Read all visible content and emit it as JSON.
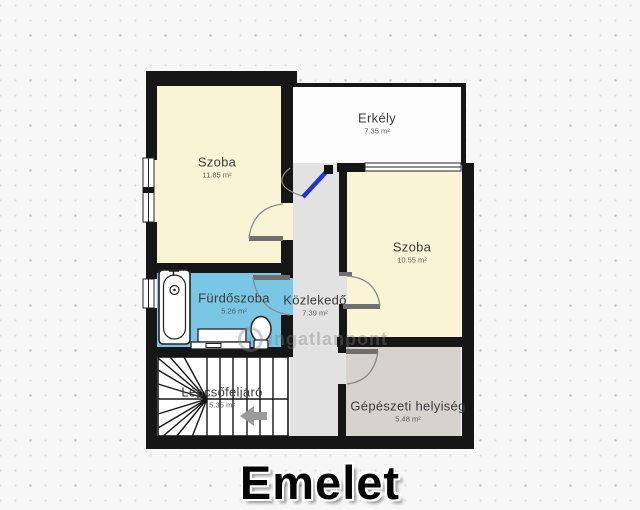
{
  "title": "Emelet",
  "watermark": {
    "brand": "otp",
    "name": "ingatlanpont"
  },
  "rooms": {
    "szoba1": {
      "label": "Szoba",
      "area": "11.85 m²"
    },
    "erkely": {
      "label": "Erkély",
      "area": "7.35 m²"
    },
    "szoba2": {
      "label": "Szoba",
      "area": "10.55 m²"
    },
    "furdoszoba": {
      "label": "Fürdőszoba",
      "area": "5.26 m²"
    },
    "kozlekedo": {
      "label": "Közlekedő",
      "area": "7.39 m²"
    },
    "lepcsofeljaro": {
      "label": "Lépcsőfeljáró",
      "area": "5.35 m²"
    },
    "gepeszeti": {
      "label": "Gépészeti helyiség",
      "area": "5.48 m²"
    }
  },
  "colors": {
    "wall": "#161616",
    "room_fill": "#f8f4d5",
    "bathroom_fill": "#79c7e4",
    "corridor_fill": "#e2e2e2",
    "utility_fill": "#d6d2ce",
    "balcony_fill": "#fdfdfd",
    "stairwell_fill": "#fefefe",
    "balcony_door": "#2433cc"
  }
}
